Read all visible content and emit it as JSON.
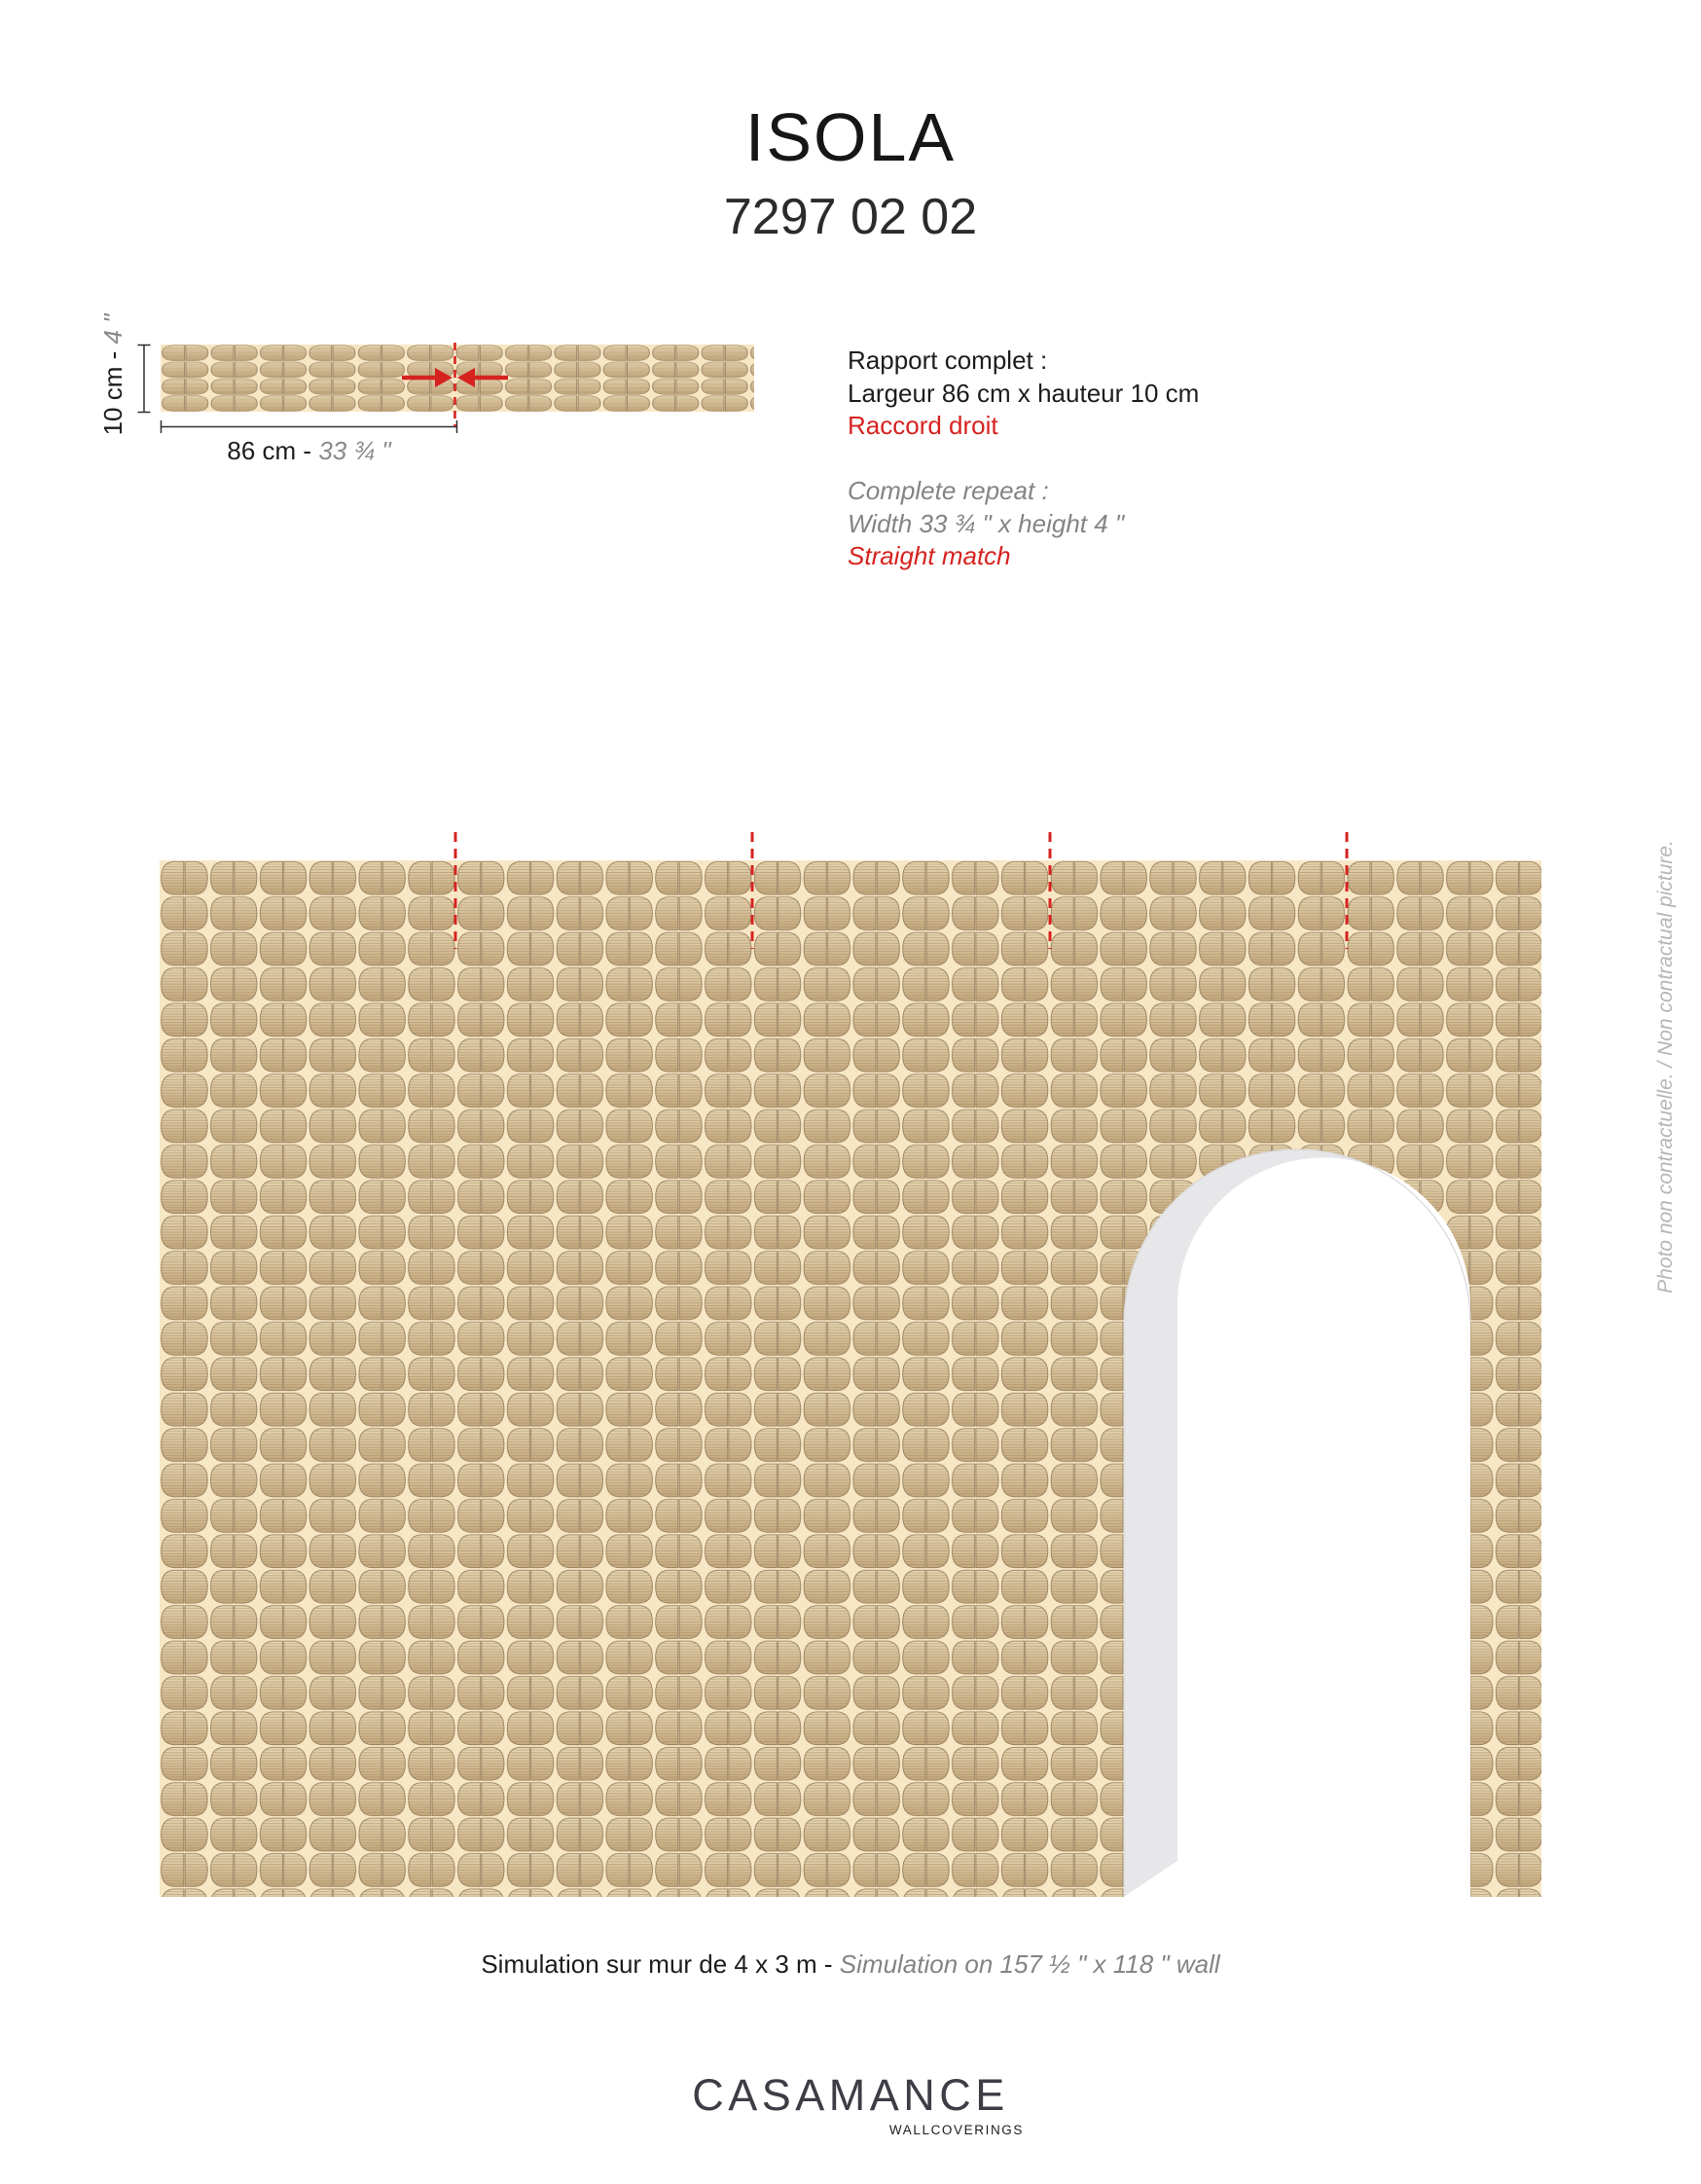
{
  "header": {
    "title": "ISOLA",
    "reference": "7297 02 02"
  },
  "repeat_diagram": {
    "height_label": {
      "metric": "10 cm - ",
      "imperial": "4 \""
    },
    "width_label": {
      "metric": "86 cm - ",
      "imperial": "33 ¾ \""
    }
  },
  "specs": {
    "french": {
      "heading": "Rapport complet :",
      "dimensions": "Largeur 86 cm x hauteur 10 cm",
      "match": "Raccord droit"
    },
    "english": {
      "heading": "Complete repeat :",
      "dimensions": "Width 33 ¾ \" x height 4 \"",
      "match": "Straight match"
    }
  },
  "simulation": {
    "caption_french": "Simulation sur mur de 4 x 3 m - ",
    "caption_english": "Simulation on 157 ½ \" x 118 \" wall",
    "side_note": "Photo non contractuelle. / Non contractual picture."
  },
  "footer": {
    "brand": "CASAMANCE",
    "tagline": "WALLCOVERINGS"
  },
  "colors": {
    "accent_red": "#d6231f",
    "text_black": "#1d1d1b",
    "text_gray": "#848484",
    "side_note_gray": "#b6b6b6",
    "logo_gray": "#3d3d45",
    "pattern_background": "#f7e7c5",
    "pattern_leaf_light": "#e7d8b4",
    "pattern_leaf_dark": "#c3a87e",
    "pattern_outline": "#83694a",
    "arch_reveal_gray": "#e7e7e9"
  }
}
